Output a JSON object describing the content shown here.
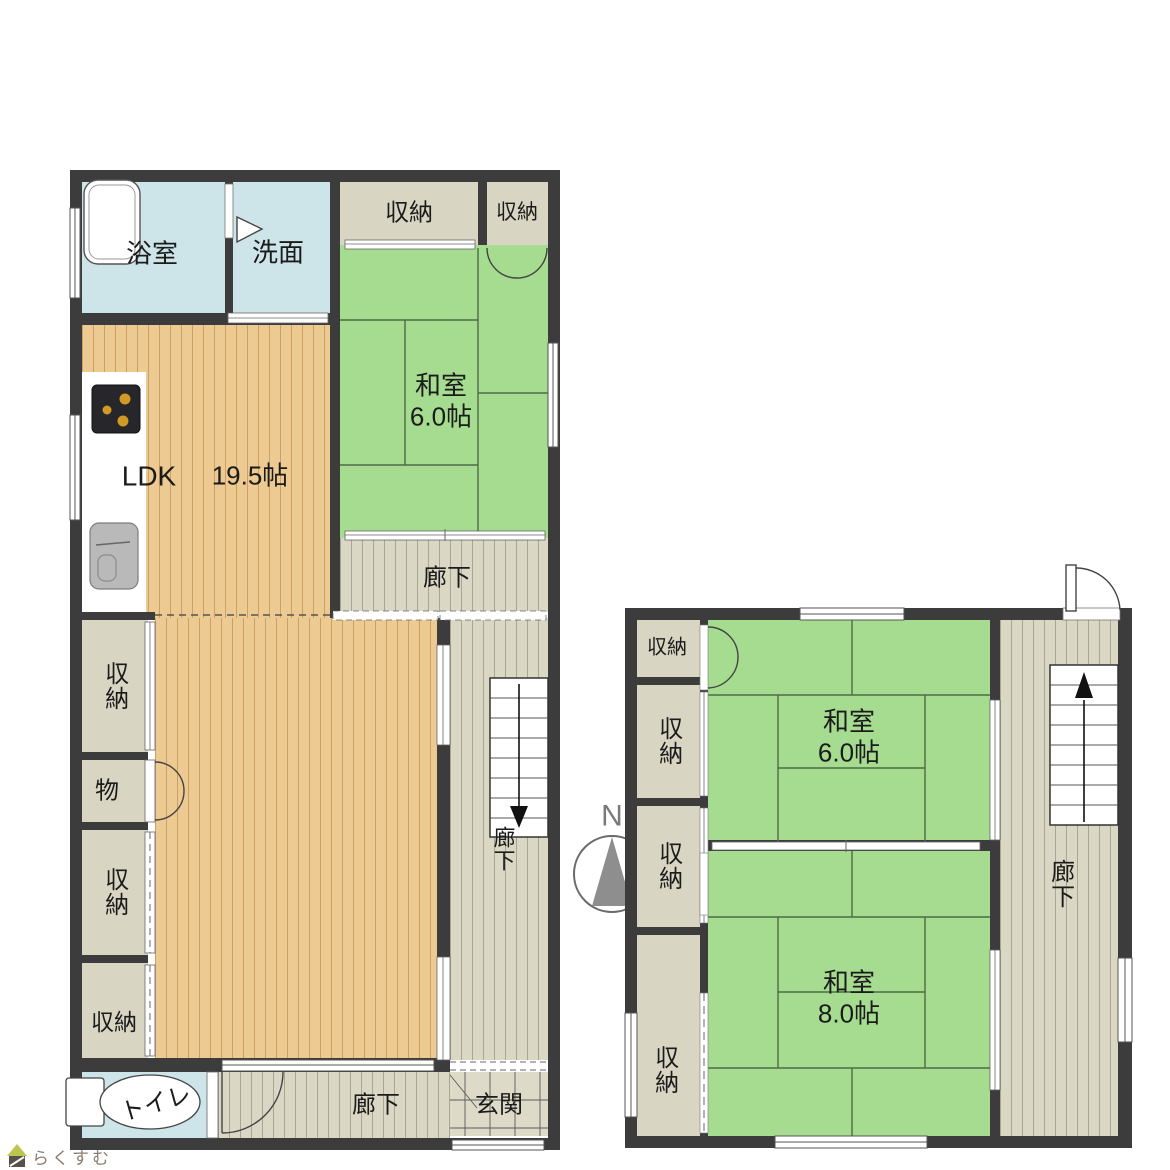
{
  "compass": {
    "north_label": "N"
  },
  "watermark": {
    "logo_text": "らくすむ"
  },
  "floor1": {
    "bath": "浴室",
    "washroom": "洗面",
    "closet_top_left": "収納",
    "closet_top_right": "収納",
    "washitsu": {
      "name": "和室",
      "size": "6.0帖"
    },
    "ldk": {
      "name": "LDK",
      "size": "19.5帖"
    },
    "hall_upper": "廊下",
    "hall_stair": "廊下",
    "hall_lower": "廊下",
    "closet_west_1": "収納",
    "closet_mono": "物",
    "closet_west_2": "収納",
    "closet_west_3": "収納",
    "toilet": "トイレ",
    "entrance": "玄関"
  },
  "floor2": {
    "closet_1": "収納",
    "closet_2": "収納",
    "closet_3": "収納",
    "closet_4": "収納",
    "washitsu_6": {
      "name": "和室",
      "size": "6.0帖"
    },
    "washitsu_8": {
      "name": "和室",
      "size": "8.0帖"
    },
    "hall": "廊下"
  },
  "colors": {
    "wall": "#3c3c3c",
    "tatami_green": "#a6dc90",
    "wood_floor": "#edca92",
    "closet_beige": "#d9d5c3",
    "hallway": "#dbd7c5",
    "water_blue": "#cde4e8",
    "entrance_tile": "#dedac8",
    "burner_gold": "#d09a24"
  }
}
